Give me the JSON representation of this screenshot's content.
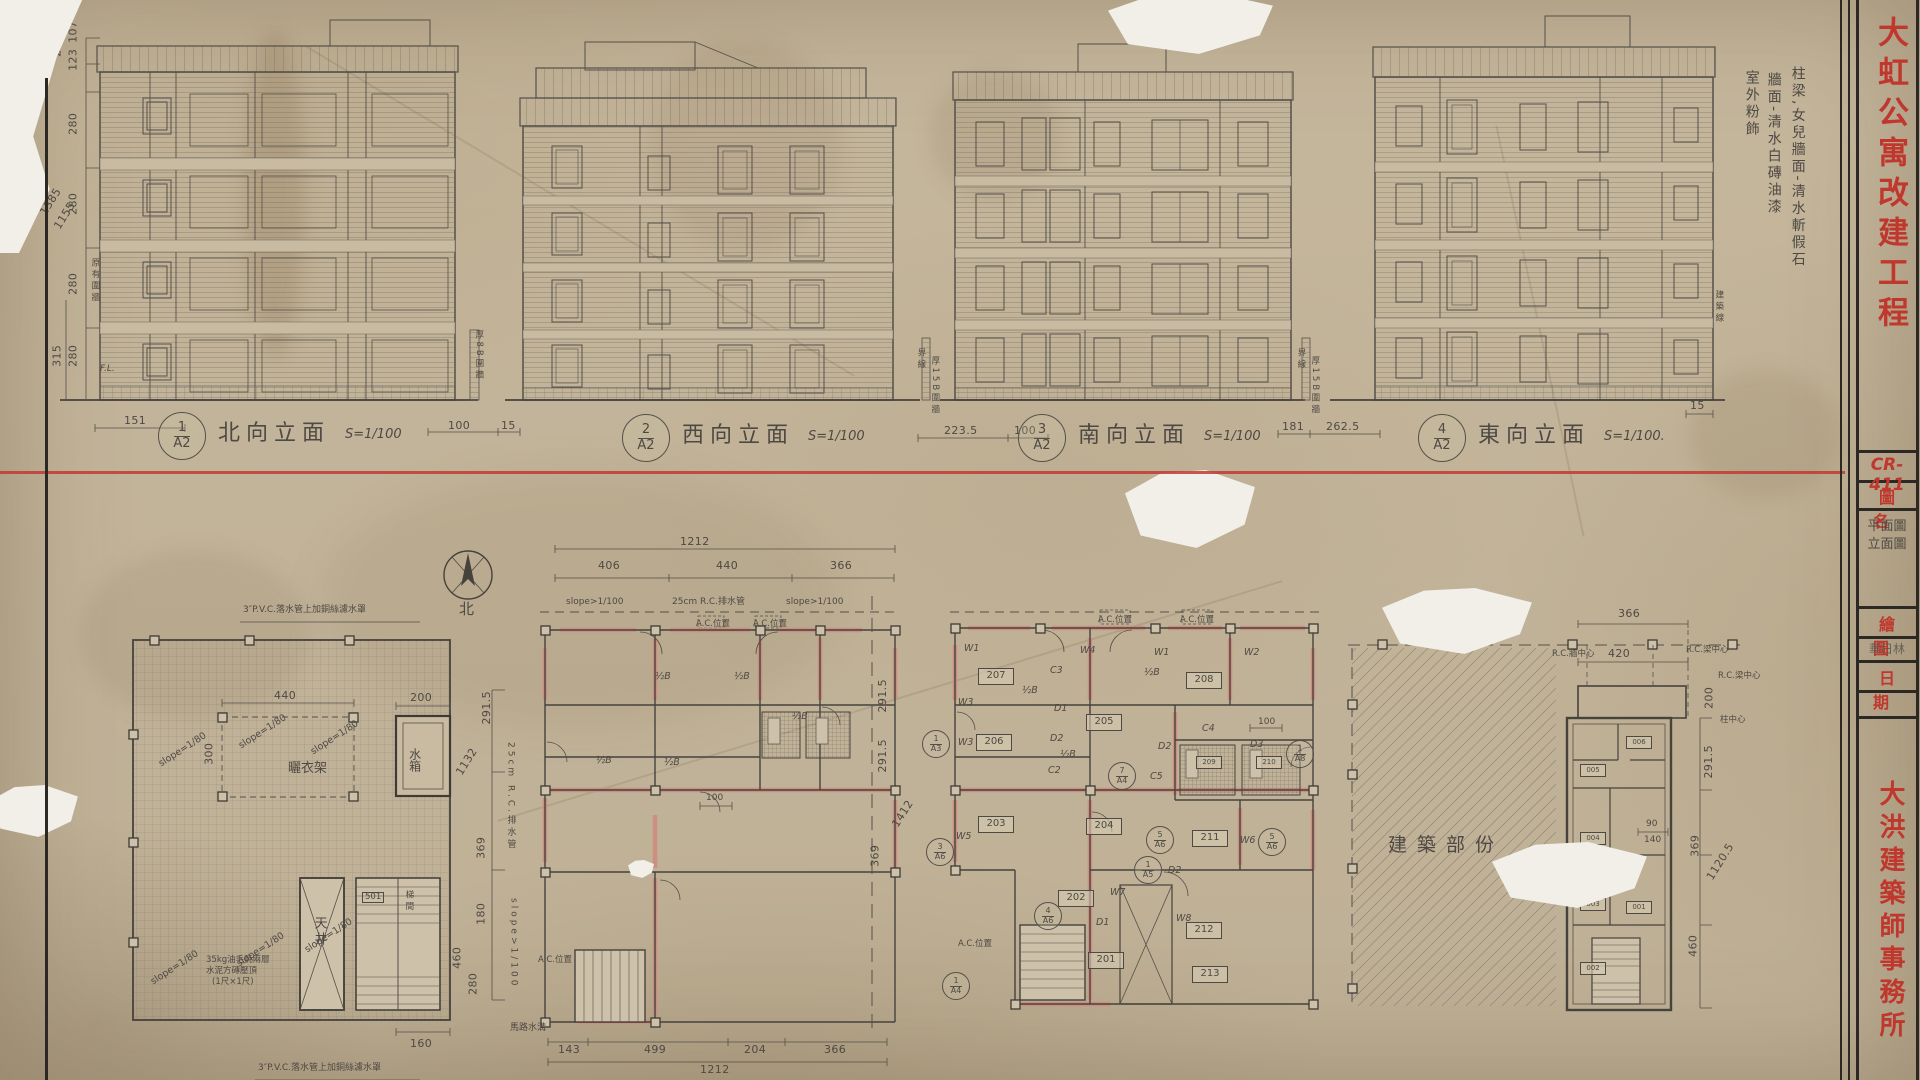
{
  "sheet": {
    "code": "CR-411",
    "project_title": "大虹公寓改建工程",
    "office": "大洪建築師事務所",
    "fields": {
      "drawing_name_label": "圖名",
      "drawing_name_1": "平面圖",
      "drawing_name_2": "立面圖",
      "drafting_label": "繪圖",
      "drafting_value": "華日林",
      "date_label": "日期"
    }
  },
  "notes": {
    "finish_a": "柱梁,女兒牆面-清水斬假石",
    "finish_b": "牆面-清水白磚油漆",
    "finish_c": "室外粉飾",
    "building_line": "建築線",
    "boundary_line": "界線",
    "existing_wall": "原有圍牆",
    "wall_8b": "厚8B圍牆",
    "wall_15b": "厚15B圍牆",
    "road_gutter": "馬路水溝",
    "pvc_note": "3″P.V.C.落水管上加銅絲濾水罩",
    "roof_note_1": "35kg油毛氈兩層",
    "roof_note_2": "水泥方磚壓頂",
    "roof_note_3": "(1尺×1尺)",
    "construction_part": "建築部份",
    "north": "北",
    "fl": "F.L."
  },
  "elevations": [
    {
      "num": "1",
      "sheet": "A2",
      "title": "北向立面",
      "scale": "S=1/100"
    },
    {
      "num": "2",
      "sheet": "A2",
      "title": "西向立面",
      "scale": "S=1/100"
    },
    {
      "num": "3",
      "sheet": "A2",
      "title": "南向立面",
      "scale": "S=1/100"
    },
    {
      "num": "4",
      "sheet": "A2",
      "title": "東向立面",
      "scale": "S=1/100."
    }
  ],
  "elev_dims": {
    "d107": "107",
    "d123": "123",
    "d230": "230",
    "d280": "280",
    "d315": "315",
    "d1385": "1385",
    "d1155": "1155",
    "d151": "151",
    "d100": "100",
    "d15": "15",
    "d223_5": "223.5",
    "d181": "181",
    "d262_5": "262.5"
  },
  "plan1": {
    "slope": "slope=1/80",
    "d440": "440",
    "d300": "300",
    "d200": "200",
    "d160": "160",
    "water_tank": "水箱",
    "drying_rack": "曬衣架",
    "light_well": "天井",
    "stair": "梯間",
    "s501": "501"
  },
  "plan2": {
    "total": "1212",
    "d406": "406",
    "d440": "440",
    "d366": "366",
    "slope": "slope>1/100",
    "drain": "25cm R.C.排水管",
    "ac": "A.C.位置",
    "half_b": "½B",
    "d291_5": "291.5",
    "d369": "369",
    "d1412": "1412",
    "d1132": "1132",
    "d180": "180",
    "d280": "280",
    "d460": "460",
    "d100": "100",
    "d143": "143",
    "d499": "499",
    "d204": "204"
  },
  "plan3": {
    "rooms": [
      "201",
      "202",
      "203",
      "204",
      "205",
      "206",
      "207",
      "208",
      "209",
      "210",
      "211",
      "212",
      "213"
    ],
    "refs": [
      {
        "n": "1",
        "s": "A3"
      },
      {
        "n": "3",
        "s": "A6"
      },
      {
        "n": "7",
        "s": "A4"
      },
      {
        "n": "4",
        "s": "A6"
      },
      {
        "n": "1",
        "s": "A4"
      },
      {
        "n": "5",
        "s": "A6"
      },
      {
        "n": "5",
        "s": "A6"
      },
      {
        "n": "1",
        "s": "A5"
      },
      {
        "n": "1",
        "s": "A8"
      }
    ],
    "w1": "W1",
    "w2": "W2",
    "w3": "W3",
    "w4": "W4",
    "w5": "W5",
    "w6": "W6",
    "w7": "W7",
    "w8": "W8",
    "dr1": "D1",
    "dr2": "D2",
    "dr3": "D3",
    "c2": "C2",
    "c3": "C3",
    "c4": "C4",
    "c5": "C5",
    "d100": "100"
  },
  "plan4": {
    "d366": "366",
    "d420": "420",
    "wall_cl": "R.C.牆中心",
    "beam_cl": "R.C.梁中心",
    "col_cl": "柱中心",
    "d200": "200",
    "d291_5": "291.5",
    "d90": "90",
    "d140": "140",
    "d369": "369",
    "d1120_5": "1120.5",
    "d460": "460",
    "rooms": [
      "001",
      "002",
      "003",
      "004",
      "005",
      "006"
    ]
  }
}
